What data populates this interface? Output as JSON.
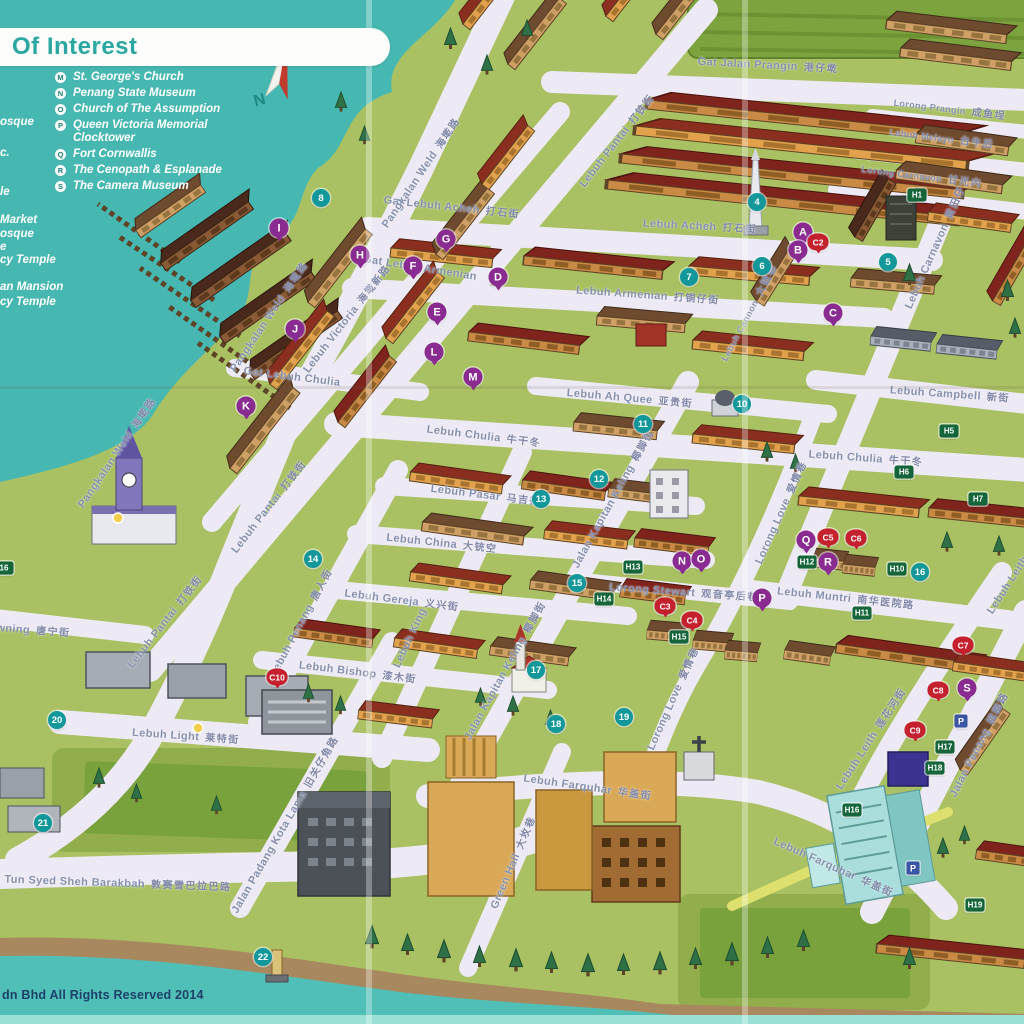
{
  "legend": {
    "title": "Of Interest",
    "items": [
      {
        "key": "M",
        "label": "St. George's Church"
      },
      {
        "key": "N",
        "label": "Penang State Museum"
      },
      {
        "key": "O",
        "label": "Church of The Assumption"
      },
      {
        "key": "P",
        "label": "Queen Victoria Memorial Clocktower"
      },
      {
        "key": "Q",
        "label": "Fort Cornwallis"
      },
      {
        "key": "R",
        "label": "The Cenopath & Esplanade"
      },
      {
        "key": "S",
        "label": "The Camera Museum"
      }
    ],
    "left_partial_items": [
      {
        "text": "osque",
        "y": 116
      },
      {
        "text": "c.",
        "y": 147
      },
      {
        "text": "le",
        "y": 186
      },
      {
        "text": "Market",
        "y": 214
      },
      {
        "text": "osque",
        "y": 228
      },
      {
        "text": "e",
        "y": 241
      },
      {
        "text": "cy Temple",
        "y": 254
      },
      {
        "text": "an Mansion",
        "y": 281
      },
      {
        "text": "cy Temple",
        "y": 296
      }
    ]
  },
  "compass": {
    "north_label": "N"
  },
  "footer": {
    "copyright": "dn Bhd All Rights Reserved 2014"
  },
  "colors": {
    "water": "#45b5b0",
    "land": "#a9c162",
    "road": "#edeaf5",
    "accent_teal": "#2aa7a2",
    "marker_teal": "#12989a",
    "marker_purple": "#8a2b91",
    "marker_red": "#c4202e",
    "marker_green": "#14663a",
    "marker_blue": "#3b55a5",
    "street_text": "#8691af"
  },
  "streets": [
    {
      "label": "Gat Jalan Prangin",
      "zh": "港仔墘",
      "x": 768,
      "y": 64,
      "rot": 3
    },
    {
      "label": "Lorong Prangin",
      "zh": "成鱼埕",
      "x": 950,
      "y": 108,
      "rot": 7,
      "fs": 9
    },
    {
      "label": "Lebuh Melayu",
      "zh": "台牛后",
      "x": 942,
      "y": 137,
      "rot": 7,
      "fs": 9
    },
    {
      "label": "Lorong Carnavon",
      "zh": "甘光内",
      "x": 922,
      "y": 175,
      "rot": 7,
      "fs": 9
    },
    {
      "label": "Gat Lebuh Acheh",
      "zh": "打石街",
      "x": 452,
      "y": 206,
      "rot": 6
    },
    {
      "label": "Lebuh Acheh",
      "zh": "打石街",
      "x": 700,
      "y": 225,
      "rot": 3
    },
    {
      "label": "Gat Lebuh Armenian",
      "zh": "",
      "x": 420,
      "y": 268,
      "rot": 9
    },
    {
      "label": "Lebuh Armenian",
      "zh": "打铜仔街",
      "x": 648,
      "y": 294,
      "rot": 4
    },
    {
      "label": "Lebuh Cannon",
      "zh": "大铳巷",
      "x": 748,
      "y": 312,
      "rot": -62,
      "fs": 9
    },
    {
      "label": "Lebuh Carnavon",
      "zh": "黄田仔",
      "x": 934,
      "y": 247,
      "rot": -66
    },
    {
      "label": "Lebuh Campbell",
      "zh": "新街",
      "x": 950,
      "y": 393,
      "rot": 4
    },
    {
      "label": "Lebuh Ah Quee",
      "zh": "亚贵街",
      "x": 630,
      "y": 397,
      "rot": 5
    },
    {
      "label": "Lebuh Chulia",
      "zh": "牛干冬",
      "x": 484,
      "y": 435,
      "rot": 7
    },
    {
      "label": "Lebuh Chulia",
      "zh": "牛干冬",
      "x": 866,
      "y": 457,
      "rot": 4
    },
    {
      "label": "Lebuh Pasar",
      "zh": "马吉街",
      "x": 486,
      "y": 494,
      "rot": 7
    },
    {
      "label": "Lebuh China",
      "zh": "大铳空",
      "x": 442,
      "y": 542,
      "rot": 6
    },
    {
      "label": "Lebuh Gereja",
      "zh": "义兴街",
      "x": 402,
      "y": 599,
      "rot": 7
    },
    {
      "label": "Lebuh Bishop",
      "zh": "漆木街",
      "x": 358,
      "y": 671,
      "rot": 7
    },
    {
      "label": "Lebuh Light",
      "zh": "莱特街",
      "x": 186,
      "y": 735,
      "rot": 4
    },
    {
      "label": "Lebuh Farquhar",
      "zh": "华盖街",
      "x": 588,
      "y": 786,
      "rot": 8
    },
    {
      "label": "Lebuh Farquhar",
      "zh": "华盖街",
      "x": 834,
      "y": 866,
      "rot": 24
    },
    {
      "label": "Lebuh Muntri",
      "zh": "南华医院路",
      "x": 846,
      "y": 597,
      "rot": 6
    },
    {
      "label": "Lorong Stewart",
      "zh": "观音亭后巷",
      "x": 684,
      "y": 591,
      "rot": 4
    },
    {
      "label": "Tun Syed Sheh Barakbah",
      "zh": "敦赛雪巴拉巴路",
      "x": 118,
      "y": 882,
      "rot": 2
    },
    {
      "label": "owning",
      "zh": "唐宁街",
      "x": 30,
      "y": 629,
      "rot": 4
    },
    {
      "label": "Pangkalan Weld",
      "zh": "海墘路",
      "x": 420,
      "y": 172,
      "rot": -56
    },
    {
      "label": "Pangkalan Weld",
      "zh": "海墘路",
      "x": 268,
      "y": 316,
      "rot": -56
    },
    {
      "label": "Pangkalan Weld",
      "zh": "海墘路",
      "x": 116,
      "y": 452,
      "rot": -56
    },
    {
      "label": "Lebuh Pantai",
      "zh": "打铁街",
      "x": 616,
      "y": 140,
      "rot": -52
    },
    {
      "label": "Lebuh Pantai",
      "zh": "打铁街",
      "x": 268,
      "y": 506,
      "rot": -52
    },
    {
      "label": "Lebuh Pantai",
      "zh": "打铁街",
      "x": 164,
      "y": 621,
      "rot": -52
    },
    {
      "label": "Lebuh Victoria",
      "zh": "海墘新路",
      "x": 346,
      "y": 318,
      "rot": -52
    },
    {
      "label": "Gat Lebuh Chulia",
      "zh": "",
      "x": 292,
      "y": 377,
      "rot": 7
    },
    {
      "label": "Lebuh Penang",
      "zh": "唐人街",
      "x": 300,
      "y": 622,
      "rot": -62
    },
    {
      "label": "Lebuh King",
      "zh": "",
      "x": 410,
      "y": 638,
      "rot": -65
    },
    {
      "label": "Jalan Kapitan Keling",
      "zh": "椰脚街",
      "x": 612,
      "y": 498,
      "rot": -61
    },
    {
      "label": "Jalan Kapitan Keling",
      "zh": "椰脚街",
      "x": 504,
      "y": 670,
      "rot": -61
    },
    {
      "label": "Lorong Love",
      "zh": "爱情巷",
      "x": 780,
      "y": 512,
      "rot": -66
    },
    {
      "label": "Lorong Love",
      "zh": "爱情巷",
      "x": 672,
      "y": 698,
      "rot": -66
    },
    {
      "label": "Lebuh Leith",
      "zh": "莲花河街",
      "x": 870,
      "y": 738,
      "rot": -57
    },
    {
      "label": "Lebuh Leith",
      "zh": "",
      "x": 1008,
      "y": 585,
      "rot": -57
    },
    {
      "label": "Jalan Penang",
      "zh": "槟榔路",
      "x": 978,
      "y": 744,
      "rot": -63
    },
    {
      "label": "Green Hall",
      "zh": "大坆巷",
      "x": 512,
      "y": 862,
      "rot": -67
    },
    {
      "label": "Jalan Padang Kota Lama",
      "zh": "旧关仔角路",
      "x": 284,
      "y": 824,
      "rot": -60
    }
  ],
  "markers": {
    "numbered": [
      {
        "label": "4",
        "x": 757,
        "y": 202
      },
      {
        "label": "5",
        "x": 888,
        "y": 262
      },
      {
        "label": "6",
        "x": 762,
        "y": 266
      },
      {
        "label": "7",
        "x": 689,
        "y": 277
      },
      {
        "label": "8",
        "x": 321,
        "y": 198
      },
      {
        "label": "10",
        "x": 742,
        "y": 404
      },
      {
        "label": "11",
        "x": 643,
        "y": 424
      },
      {
        "label": "12",
        "x": 599,
        "y": 479
      },
      {
        "label": "13",
        "x": 541,
        "y": 499
      },
      {
        "label": "14",
        "x": 313,
        "y": 559
      },
      {
        "label": "15",
        "x": 577,
        "y": 583
      },
      {
        "label": "16",
        "x": 920,
        "y": 572
      },
      {
        "label": "17",
        "x": 536,
        "y": 670
      },
      {
        "label": "18",
        "x": 556,
        "y": 724
      },
      {
        "label": "19",
        "x": 624,
        "y": 717
      },
      {
        "label": "20",
        "x": 57,
        "y": 720
      },
      {
        "label": "21",
        "x": 43,
        "y": 823
      },
      {
        "label": "22",
        "x": 263,
        "y": 957
      }
    ],
    "lettered": [
      {
        "label": "A",
        "x": 803,
        "y": 232
      },
      {
        "label": "B",
        "x": 798,
        "y": 250
      },
      {
        "label": "C",
        "x": 833,
        "y": 313
      },
      {
        "label": "D",
        "x": 498,
        "y": 277
      },
      {
        "label": "E",
        "x": 437,
        "y": 312
      },
      {
        "label": "F",
        "x": 413,
        "y": 266
      },
      {
        "label": "G",
        "x": 446,
        "y": 239
      },
      {
        "label": "H",
        "x": 360,
        "y": 255
      },
      {
        "label": "I",
        "x": 279,
        "y": 228
      },
      {
        "label": "J",
        "x": 295,
        "y": 329
      },
      {
        "label": "K",
        "x": 246,
        "y": 406
      },
      {
        "label": "L",
        "x": 434,
        "y": 352
      },
      {
        "label": "M",
        "x": 473,
        "y": 377
      },
      {
        "label": "N",
        "x": 682,
        "y": 561
      },
      {
        "label": "O",
        "x": 701,
        "y": 559
      },
      {
        "label": "P",
        "x": 762,
        "y": 598
      },
      {
        "label": "Q",
        "x": 806,
        "y": 540
      },
      {
        "label": "R",
        "x": 828,
        "y": 562
      },
      {
        "label": "S",
        "x": 967,
        "y": 688
      }
    ],
    "red_pins": [
      {
        "label": "C2",
        "x": 818,
        "y": 242
      },
      {
        "label": "C3",
        "x": 665,
        "y": 606
      },
      {
        "label": "C4",
        "x": 692,
        "y": 620
      },
      {
        "label": "C5",
        "x": 828,
        "y": 537
      },
      {
        "label": "C6",
        "x": 856,
        "y": 538
      },
      {
        "label": "C7",
        "x": 963,
        "y": 645
      },
      {
        "label": "C8",
        "x": 938,
        "y": 690
      },
      {
        "label": "C9",
        "x": 915,
        "y": 730
      },
      {
        "label": "C10",
        "x": 277,
        "y": 677
      }
    ],
    "heritage": [
      {
        "label": "H1",
        "x": 917,
        "y": 195
      },
      {
        "label": "H5",
        "x": 949,
        "y": 431
      },
      {
        "label": "H6",
        "x": 904,
        "y": 472
      },
      {
        "label": "H7",
        "x": 978,
        "y": 499
      },
      {
        "label": "H10",
        "x": 897,
        "y": 569
      },
      {
        "label": "H11",
        "x": 862,
        "y": 613
      },
      {
        "label": "H12",
        "x": 807,
        "y": 562
      },
      {
        "label": "H13",
        "x": 633,
        "y": 567
      },
      {
        "label": "H14",
        "x": 604,
        "y": 599
      },
      {
        "label": "H15",
        "x": 679,
        "y": 637
      },
      {
        "label": "H16",
        "x": 852,
        "y": 810
      },
      {
        "label": "H17",
        "x": 945,
        "y": 747
      },
      {
        "label": "H18",
        "x": 935,
        "y": 768
      },
      {
        "label": "H19",
        "x": 975,
        "y": 905
      },
      {
        "label": "16",
        "x": 4,
        "y": 568
      }
    ],
    "parking": [
      {
        "label": "P",
        "x": 961,
        "y": 721
      },
      {
        "label": "P",
        "x": 913,
        "y": 868
      }
    ]
  }
}
